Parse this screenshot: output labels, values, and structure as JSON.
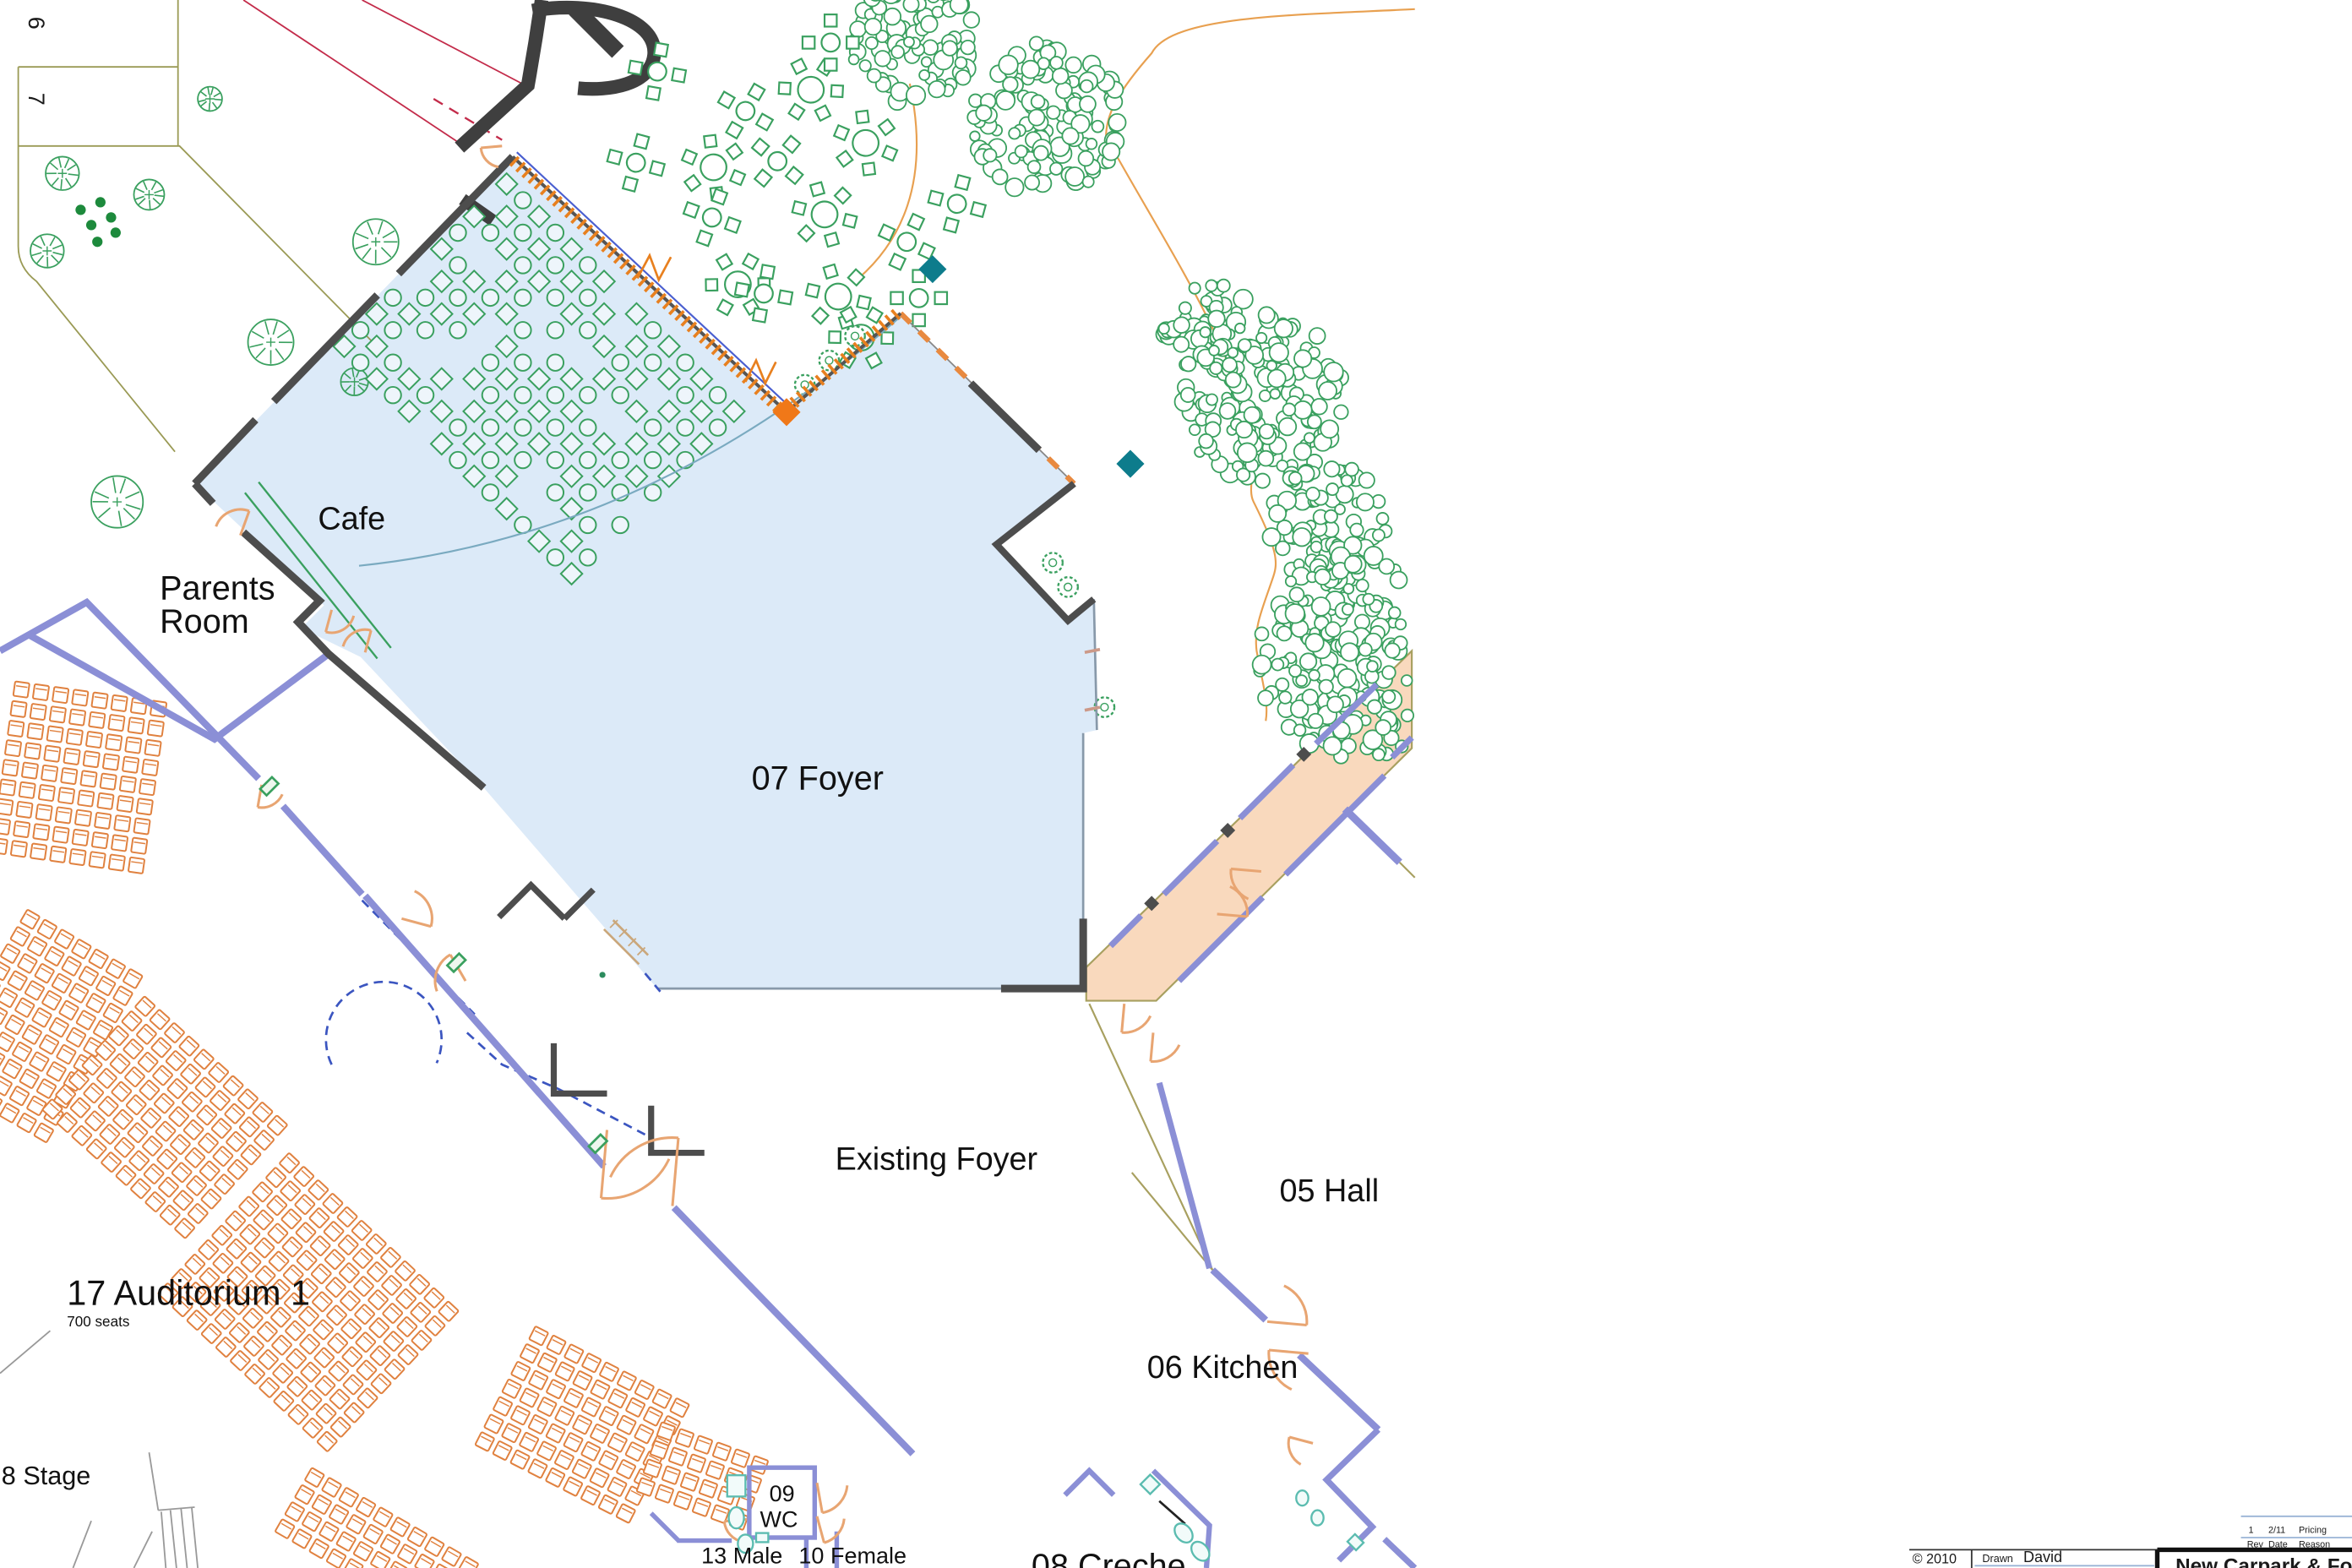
{
  "drawing": {
    "rooms": {
      "cafe": "Cafe",
      "parents_room_line1": "Parents",
      "parents_room_line2": "Room",
      "foyer": "07 Foyer",
      "existing_foyer": "Existing Foyer",
      "hall": "05  Hall",
      "kitchen": "06 Kitchen",
      "auditorium": "17 Auditorium 1",
      "auditorium_capacity": "700 seats",
      "stage": "8 Stage",
      "wc_number": "09",
      "wc_label": "WC",
      "male": "13 Male",
      "female": "10 Female",
      "creche": "08 Creche"
    },
    "plot_numbers": {
      "plot6": "6",
      "plot7": "7"
    }
  },
  "title_block": {
    "copyright": "© 2010",
    "company": "David Todd Ltd",
    "drawn_label": "Drawn",
    "drawn_value": "David",
    "date_value": "14 April 2010",
    "project_title": "New Carpark & Fore",
    "revision": {
      "rev": "1",
      "date": "2/11",
      "reason": "Pricing",
      "header_rev": "Rev",
      "header_date": "Date",
      "header_reason": "Reason"
    }
  },
  "colors": {
    "foyer_fill": "#dceaf8",
    "corridor_fill": "#f9d9bd",
    "wall_existing": "#8b8fd6",
    "wall_new": "#4d4d4d",
    "landscape_green": "#3aa05f",
    "shrub_green": "#1d8a3c",
    "seating_orange": "#e0813f",
    "door_orange": "#e8a572",
    "glazing_orange": "#e8801f",
    "marker_teal": "#0d7c8c",
    "road_dark": "#3f3f3f",
    "site_line_olive": "#9a9a55",
    "dimension_red": "#c32b4a",
    "demolition_blue": "#3b55c0",
    "title_orange": "#d98e3f",
    "title_blue": "#9ab4d6",
    "fixture_teal": "#5bbcb0"
  }
}
